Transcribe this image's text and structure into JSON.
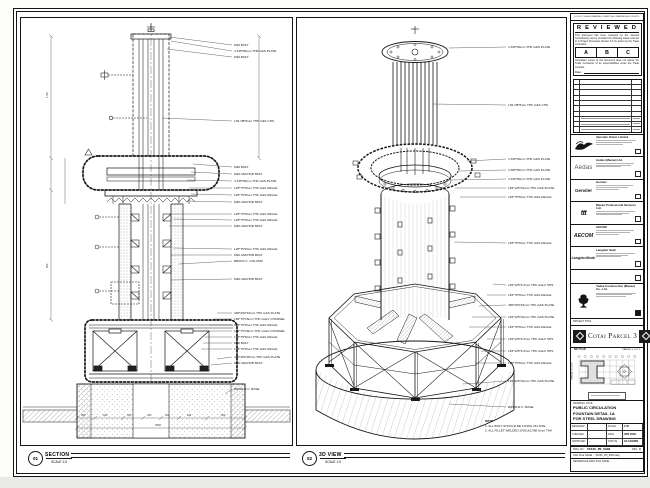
{
  "top_note": "DO NOT SCALE DRAWING. VERIFY ALL DIMENSIONS ON SITE.",
  "stamp": {
    "title": "R E V I E W E D",
    "body1": "This document has been reviewed by the relevant Consultant(s) and is provided the following status referred to in Project Procedure Section 5.4 for action by the Trade Contractor.",
    "options": [
      "A",
      "B",
      "C"
    ],
    "body2": "Consultant review of this document does not relieve the Trade Contractor of its responsibilities under the Trade Contract.",
    "date_label": "Date :"
  },
  "consultants": [
    {
      "name": "Venetian Orient Limited",
      "logo": ""
    },
    {
      "name": "Aedas (Macau) Ltd.",
      "logo": "Aedas"
    },
    {
      "name": "Gensler",
      "logo": "Gensler"
    },
    {
      "name": "Macau Professional Services Ltd.",
      "logo": "ttt"
    },
    {
      "name": "AECOM",
      "logo": "AECOM"
    },
    {
      "name": "Langdon Seah",
      "logo": "LangdonSeah"
    }
  ],
  "contractor": {
    "name": "Yadea Construction (Macau) Co., Ltd."
  },
  "project": {
    "label": "PROJECT TITLE",
    "title": "Cotai Parcel 3"
  },
  "keyplan": {
    "label": "KEY PLAN",
    "lot2": "PARCEL 3, LOT 2",
    "lot1": "PARCEL 3, LOT 1"
  },
  "drawing_title": {
    "label": "DRAWING TITLE:",
    "line1": "PUBLIC CIRCULATION",
    "line2": "FOUNTAIN DETAIL 1A",
    "line3": "FOR STEEL DRAWING"
  },
  "fields": {
    "r1l": "DESIGNED",
    "r1lv": "",
    "r1r": "SCALE",
    "r1rv": "1:50",
    "r2l": "CHECKED",
    "r2lv": "-",
    "r2r": "DATE",
    "r2rv": "APR 2009",
    "r3l": "APPROVED",
    "r3lv": "-",
    "r3r": "STATUS",
    "r3rv": "AS SHOWN"
  },
  "dwg": {
    "no_label": "DWG NO :",
    "no": "51535_PD_5000",
    "rev_label": "REV",
    "rev": "C",
    "cad_label": "CAD FILE NAME :",
    "cad": "51535_PD_5000.dwg",
    "ref_label": "REFERENCE DWG FILE NAME :"
  },
  "views": {
    "section": {
      "num": "01",
      "name": "SECTION",
      "scale": "SCALE 1:5"
    },
    "iso": {
      "num": "02",
      "name": "3D VIEW",
      "scale": "SCALE 1:5"
    }
  },
  "notes": {
    "title": "NOTE:",
    "n1": "1. ALL BOLT SHOULD BE FIXING ON SITE.",
    "n2": "2. ALL FILLET WELDED SHOULD BE 6mm THK."
  },
  "left_labels": [
    "M20 BOLT",
    "4 345*50mm THK G&S PLATE",
    "M20 BOLT",
    "139.7Ø*8mm THK G&S CHS",
    "M20 BOLT",
    "M20 ANCHOR BOLT",
    "4 345*50mm THK G&S PLATE",
    "125*75*8mm THK G&S ANGLE",
    "125*75*8mm THK G&S ANGLE",
    "M20 ANCHOR BOLT",
    "125*75*8mm THK G&S ANGLE",
    "125*75*8mm THK G&S ANGLE",
    "M20 ANCHOR BOLT",
    "125*75*8mm THK G&S ANGLE",
    "M20 ANCHOR BOLT",
    "Ø800 R.C. COLUMN",
    "M20 ANCHOR BOLT",
    "400*200*16mm THK G&S PLATE",
    "150*75*18mm THK GALV CHANNEL",
    "125*75*8mm THK G&S ANGLE",
    "150*75*18mm THK GALV CHANNEL",
    "125*75*8mm THK G&S ANGLE",
    "M20 BOLT",
    "125*75*8mm THK G&S ANGLE",
    "450*450*20mm THK G&S PLATE",
    "M20 ANCHOR BOLT",
    "Ø2500 R.C. BASE"
  ],
  "right_labels": [
    "4 345*50mm THK G&S PLATE",
    "139.7Ø*8mm THK G&S CHS",
    "4 345*50mm THK G&S PLATE",
    "4 395*50mm THK G&S PLATE",
    "4 345*50mm THK G&S PLATE",
    "125*125*10mm THK G&S PLATE",
    "125*75*8mm THK G&S ANGLE",
    "125*75*8mm THK G&S ANGLE",
    "125*125*6.3mm THK GALV SHS",
    "125*75*8mm THK G&S ANGLE",
    "450*200*16mm THK G&S PLATE",
    "125*125*10mm THK G&S PLATE",
    "125*75*8mm THK G&S ANGLE",
    "125*125*6.3mm THK GALV SHS",
    "125*125*6.3mm THK GALV SHS",
    "125*75*8mm THK G&S ANGLE",
    "125*125*10mm THK G&S PLATE",
    "Ø2500 R.C. BASE"
  ],
  "dims": {
    "v1": "1750",
    "v2": "800",
    "chain": [
      "300",
      "944",
      "300",
      "450",
      "300",
      "944",
      "300"
    ],
    "total": "3538"
  }
}
